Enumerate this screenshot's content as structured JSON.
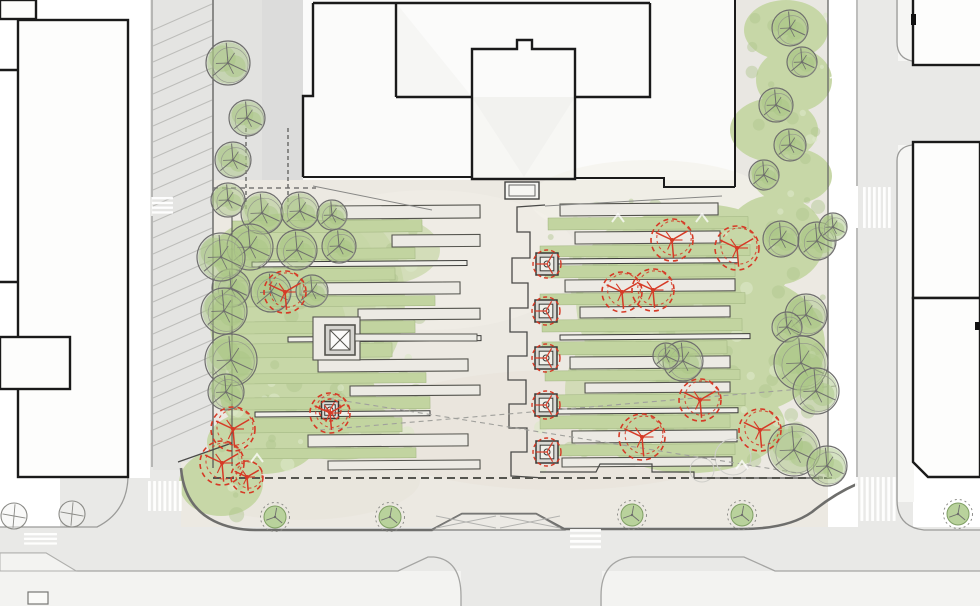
{
  "meta": {
    "drawing": "landscape-architecture-site-plan",
    "view": "plan",
    "content": "public plaza between street blocks with terraced lawn fingers, existing trees, proposed trees, street trees, crosswalks and parking lanes"
  },
  "palette": {
    "background": "#ffffff",
    "street": "#e9e9e7",
    "street_dark": "#e2e2e0",
    "parking_wash": "#dbdbd9",
    "plaza": "#ece9e2",
    "sidewalk": "#f3f3f1",
    "building_fill": "#fdfdfc",
    "building_outline": "#1a1a1a",
    "curb": "#9b9b99",
    "heavy_curb": "#6e6e6c",
    "lawn": "#c7d7a7",
    "lawn_strip": "#c2d4a0",
    "lawn_dark": "#b0c68d",
    "lawn_light": "#dce7c8",
    "foliage": "#a9c585",
    "tree_line": "#6f6f6d",
    "proposed_red": "#d63a26",
    "strip_line": "#54544e",
    "bench_line": "#3c3c3a",
    "paving_strip": "#eceae4",
    "bench_fill": "#f0efe9",
    "dash_line": "#5c5c5a",
    "hatch_gray": "#b9b9b6",
    "white_marking": "#ffffff"
  },
  "plan": {
    "hatches": [
      {
        "x": 153,
        "y": 30,
        "w": 59,
        "h": 430,
        "step": 16,
        "rise": 26,
        "color": "#b9b9b6",
        "width": 1,
        "opacity": 0.9
      },
      {
        "x": 830,
        "y": 36,
        "w": 27,
        "h": 136,
        "step": 14,
        "rise": 12,
        "color": "#ffffff",
        "width": 1.6,
        "opacity": 0.85
      },
      {
        "x": 830,
        "y": 396,
        "w": 27,
        "h": 64,
        "step": 14,
        "rise": 12,
        "color": "#ffffff",
        "width": 1.6,
        "opacity": 0.85
      }
    ],
    "gardens": {
      "left": {
        "bbox": [
          222,
          218,
          210,
          250
        ],
        "strips": [
          [
            "p",
            330,
            206,
            150,
            13
          ],
          [
            "l",
            232,
            221,
            190,
            12
          ],
          [
            "p",
            392,
            235,
            88,
            12
          ],
          [
            "l",
            230,
            249,
            185,
            11
          ],
          [
            "b",
            252,
            262,
            215,
            5
          ],
          [
            "l",
            230,
            269,
            165,
            12
          ],
          [
            "p",
            300,
            283,
            160,
            12
          ],
          [
            "l",
            240,
            297,
            195,
            10
          ],
          [
            "p",
            358,
            309,
            122,
            11
          ],
          [
            "l",
            230,
            322,
            185,
            12
          ],
          [
            "b",
            288,
            337,
            193,
            5
          ],
          [
            "l",
            230,
            344,
            162,
            14
          ],
          [
            "p",
            318,
            360,
            150,
            12
          ],
          [
            "l",
            238,
            374,
            188,
            10
          ],
          [
            "p",
            350,
            386,
            130,
            10
          ],
          [
            "l",
            230,
            398,
            200,
            12
          ],
          [
            "b",
            255,
            412,
            175,
            5
          ],
          [
            "l",
            230,
            419,
            172,
            14
          ],
          [
            "p",
            308,
            435,
            160,
            12
          ],
          [
            "l",
            238,
            449,
            178,
            10
          ],
          [
            "p",
            328,
            461,
            152,
            9
          ]
        ]
      },
      "right": {
        "bbox": [
          540,
          200,
          290,
          272
        ],
        "strips": [
          [
            "p",
            560,
            204,
            158,
            12
          ],
          [
            "l",
            548,
            218,
            200,
            12
          ],
          [
            "p",
            575,
            232,
            145,
            12
          ],
          [
            "l",
            540,
            246,
            210,
            11
          ],
          [
            "b",
            553,
            259,
            185,
            5
          ],
          [
            "l",
            545,
            266,
            190,
            12
          ],
          [
            "p",
            565,
            280,
            170,
            12
          ],
          [
            "l",
            540,
            294,
            205,
            11
          ],
          [
            "p",
            580,
            307,
            150,
            11
          ],
          [
            "l",
            542,
            320,
            200,
            12
          ],
          [
            "b",
            560,
            335,
            190,
            5
          ],
          [
            "l",
            542,
            342,
            185,
            13
          ],
          [
            "p",
            570,
            357,
            160,
            12
          ],
          [
            "l",
            545,
            371,
            195,
            10
          ],
          [
            "p",
            585,
            383,
            145,
            10
          ],
          [
            "l",
            540,
            395,
            205,
            12
          ],
          [
            "b",
            558,
            409,
            180,
            5
          ],
          [
            "l",
            540,
            416,
            190,
            13
          ],
          [
            "p",
            572,
            431,
            165,
            12
          ],
          [
            "l",
            545,
            445,
            190,
            11
          ],
          [
            "p",
            562,
            458,
            170,
            9
          ]
        ]
      },
      "ne_strip_bbox": [
        742,
        8,
        84,
        192
      ],
      "sw_wedge_bbox": [
        190,
        450,
        66,
        66
      ]
    },
    "fountain": {
      "plinth": [
        313,
        317,
        47,
        43
      ],
      "square": [
        325,
        325,
        30,
        30
      ],
      "inner": [
        330,
        330,
        20,
        20
      ],
      "connector": [
        355,
        334,
        122,
        7
      ]
    },
    "stoop": {
      "outer": [
        505,
        182,
        34,
        17
      ],
      "inner": [
        509,
        185,
        26,
        11
      ]
    },
    "planters": [
      [
        547,
        264,
        22,
        14
      ],
      [
        546,
        311,
        22,
        14
      ],
      [
        546,
        358,
        22,
        14
      ],
      [
        546,
        405,
        22,
        14
      ],
      [
        547,
        452,
        22,
        14
      ],
      [
        330,
        410,
        17,
        11
      ]
    ],
    "trees": {
      "existing": [
        [
          228,
          200,
          17
        ],
        [
          262,
          213,
          21
        ],
        [
          300,
          211,
          19
        ],
        [
          332,
          215,
          15
        ],
        [
          250,
          247,
          23
        ],
        [
          297,
          250,
          20
        ],
        [
          339,
          246,
          17
        ],
        [
          231,
          288,
          19
        ],
        [
          271,
          292,
          20
        ],
        [
          312,
          291,
          16
        ],
        [
          221,
          257,
          24
        ],
        [
          224,
          311,
          23
        ],
        [
          231,
          360,
          26
        ],
        [
          226,
          392,
          18
        ],
        [
          228,
          63,
          22
        ],
        [
          247,
          118,
          18
        ],
        [
          233,
          160,
          18
        ],
        [
          790,
          28,
          18
        ],
        [
          802,
          62,
          15
        ],
        [
          776,
          105,
          17
        ],
        [
          790,
          145,
          16
        ],
        [
          764,
          175,
          15
        ],
        [
          781,
          239,
          18
        ],
        [
          817,
          241,
          19
        ],
        [
          833,
          227,
          14
        ],
        [
          806,
          315,
          21
        ],
        [
          787,
          327,
          15
        ],
        [
          801,
          363,
          27
        ],
        [
          816,
          391,
          23
        ],
        [
          794,
          450,
          26
        ],
        [
          827,
          466,
          20
        ],
        [
          683,
          361,
          20
        ],
        [
          666,
          356,
          13
        ]
      ],
      "proposed": [
        [
          285,
          292,
          21
        ],
        [
          330,
          413,
          20
        ],
        [
          233,
          429,
          22
        ],
        [
          222,
          463,
          22
        ],
        [
          247,
          477,
          16
        ],
        [
          672,
          240,
          21
        ],
        [
          737,
          248,
          22
        ],
        [
          622,
          292,
          20
        ],
        [
          653,
          290,
          21
        ],
        [
          700,
          400,
          21
        ],
        [
          760,
          430,
          21
        ],
        [
          642,
          437,
          23
        ]
      ],
      "street": [
        [
          275,
          517,
          11
        ],
        [
          390,
          517,
          11
        ],
        [
          632,
          515,
          11
        ],
        [
          742,
          515,
          11
        ],
        [
          958,
          514,
          11
        ]
      ],
      "bare": [
        [
          14,
          516,
          13
        ],
        [
          72,
          514,
          13
        ]
      ]
    },
    "crosswalks": [
      {
        "x": 148,
        "y": 481,
        "w": 36,
        "h": 30,
        "o": "v",
        "n": 7
      },
      {
        "x": 152,
        "y": 197,
        "w": 21,
        "h": 19,
        "o": "h",
        "n": 4
      },
      {
        "x": 24,
        "y": 533,
        "w": 33,
        "h": 14,
        "o": "h",
        "n": 3
      },
      {
        "x": 570,
        "y": 529,
        "w": 31,
        "h": 22,
        "o": "h",
        "n": 4
      },
      {
        "x": 855,
        "y": 477,
        "w": 43,
        "h": 44,
        "o": "v",
        "n": 8
      },
      {
        "x": 863,
        "y": 187,
        "w": 30,
        "h": 41,
        "o": "v",
        "n": 6
      }
    ],
    "chevrons": [
      [
        618,
        218
      ],
      [
        702,
        218
      ],
      [
        742,
        465
      ],
      [
        257,
        458
      ]
    ],
    "ghost_circles": [
      [
        733,
        457,
        18
      ],
      [
        702,
        470,
        12
      ]
    ],
    "sight_lines": [
      [
        320,
        430,
        836,
        386
      ],
      [
        320,
        397,
        836,
        479
      ]
    ],
    "dashed_verticals": [
      [
        246,
        128,
        212
      ],
      [
        288,
        128,
        212
      ]
    ],
    "property_line": [
      213,
      478,
      836,
      478
    ],
    "top_dash": [
      213,
      188,
      316,
      188
    ]
  }
}
